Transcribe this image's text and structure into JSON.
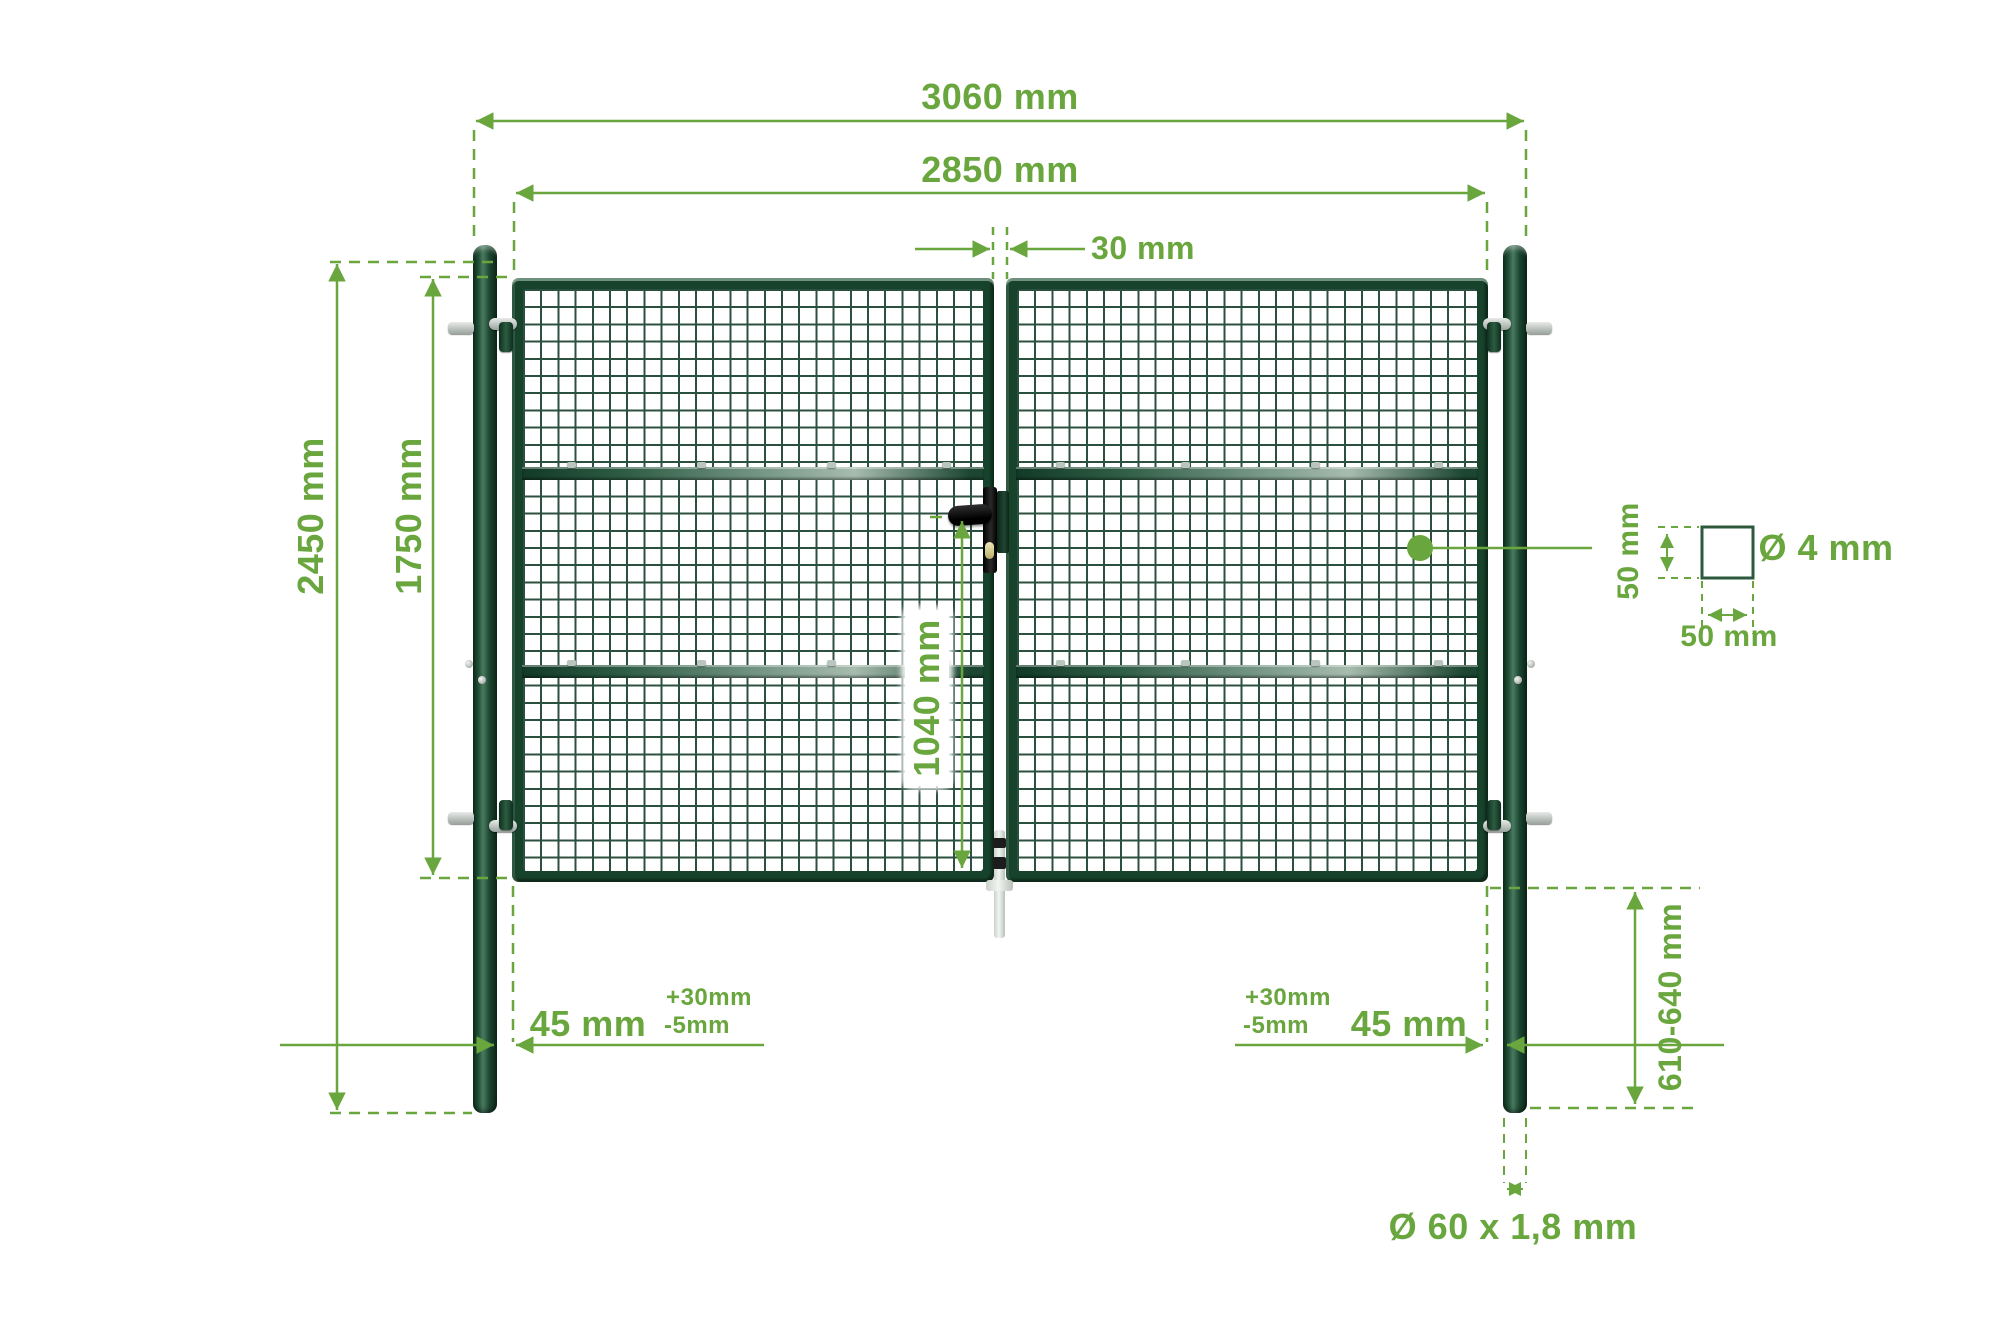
{
  "diagram": {
    "title": "double-wing mesh gate dimension drawing",
    "colors": {
      "accent_green": "#69a63d",
      "frame_dark_green": "#17422c",
      "mesh_wire_green": "#2c5040",
      "rail_light": "#a7bcae",
      "background": "#ffffff"
    },
    "labels": {
      "overall_width": "3060 mm",
      "gate_width": "2850 mm",
      "wing_gap": "30 mm",
      "post_height": "2450 mm",
      "wing_height": "1750 mm",
      "lock_to_bottom": "1040 mm",
      "post_to_wing": "45 mm",
      "tolerance_plus": "+30mm",
      "tolerance_minus": "-5mm",
      "ground_embed_depth": "610-640 mm",
      "post_tube": "Ø 60 x 1,8 mm",
      "mesh_cell_height": "50 mm",
      "mesh_cell_width": "50 mm",
      "wire_diameter": "Ø 4 mm"
    }
  }
}
